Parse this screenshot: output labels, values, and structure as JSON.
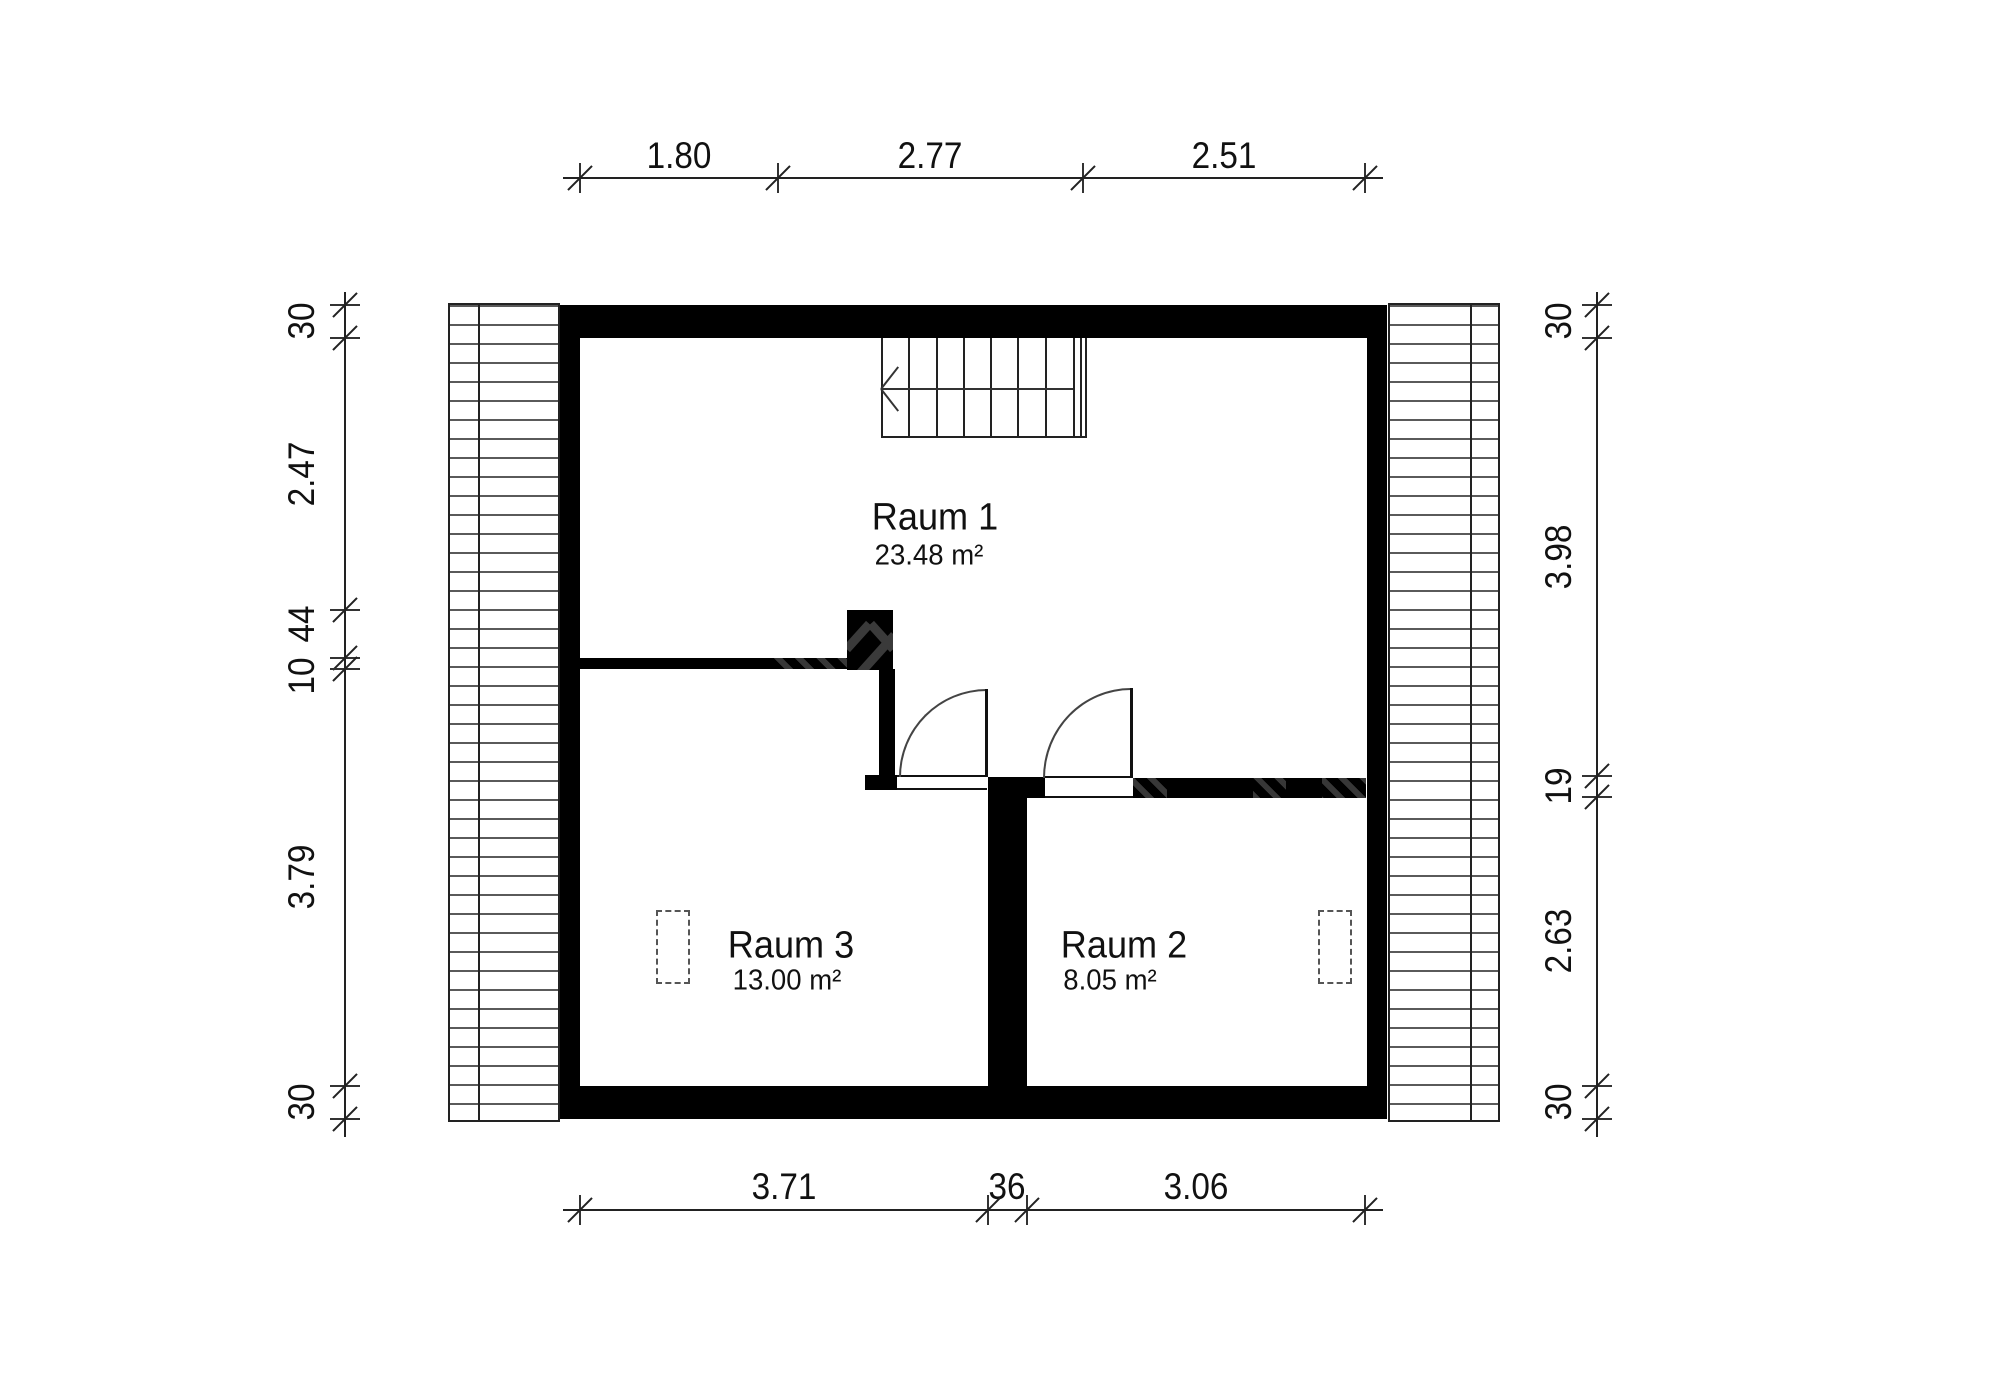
{
  "drawing_type": "floor-plan",
  "rooms": [
    {
      "name": "Raum 1",
      "area": "23.48 m²"
    },
    {
      "name": "Raum 3",
      "area": "13.00 m²"
    },
    {
      "name": "Raum 2",
      "area": "8.05 m²"
    }
  ],
  "dimensions": {
    "top": [
      "1.80",
      "2.77",
      "2.51"
    ],
    "bottom": [
      "3.71",
      "36",
      "3.06"
    ],
    "left": [
      "30",
      "2.47",
      "44",
      "10",
      "3.79",
      "30"
    ],
    "right": [
      "30",
      "3.98",
      "19",
      "2.63",
      "30"
    ]
  },
  "colors": {
    "wall": "#000000",
    "line": "#222222",
    "background": "#ffffff"
  },
  "geometry": {
    "tick_groups": [
      {
        "orient": "h",
        "line": 178,
        "coords": [
          580,
          778,
          1083,
          1365
        ]
      },
      {
        "orient": "h",
        "line": 1210,
        "coords": [
          580,
          988,
          1027,
          1365
        ]
      },
      {
        "orient": "v",
        "line": 345,
        "coords": [
          305,
          338,
          610,
          658,
          669,
          1086,
          1119
        ]
      },
      {
        "orient": "v",
        "line": 1597,
        "coords": [
          305,
          338,
          776,
          797,
          1086,
          1119
        ]
      }
    ]
  }
}
